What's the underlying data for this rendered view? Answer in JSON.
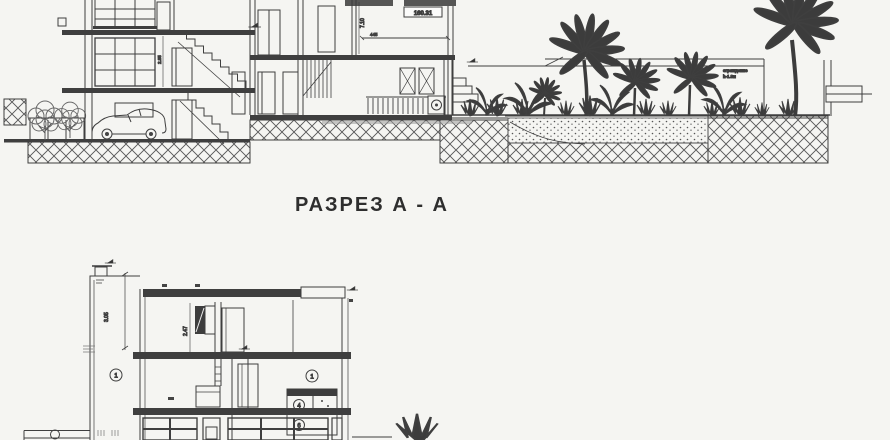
{
  "drawing": {
    "title": "РАЗРЕЗ  А - А",
    "elevation_mark": "160.31",
    "dims": {
      "h710": "7.10",
      "d445": "445",
      "h285": "2.85",
      "h305": "3.05",
      "h247": "2.47"
    },
    "fence_label": {
      "line1": "ограждение",
      "line2": "h-1.8м"
    },
    "callouts": {
      "c1": "1",
      "c2": "1",
      "c4": "4",
      "c6": "6"
    }
  },
  "colors": {
    "paper": "#f5f5f2",
    "ink": "#3b3b3b",
    "vegetation": "#3c3c3c",
    "smudge": "#9a9a9a"
  }
}
